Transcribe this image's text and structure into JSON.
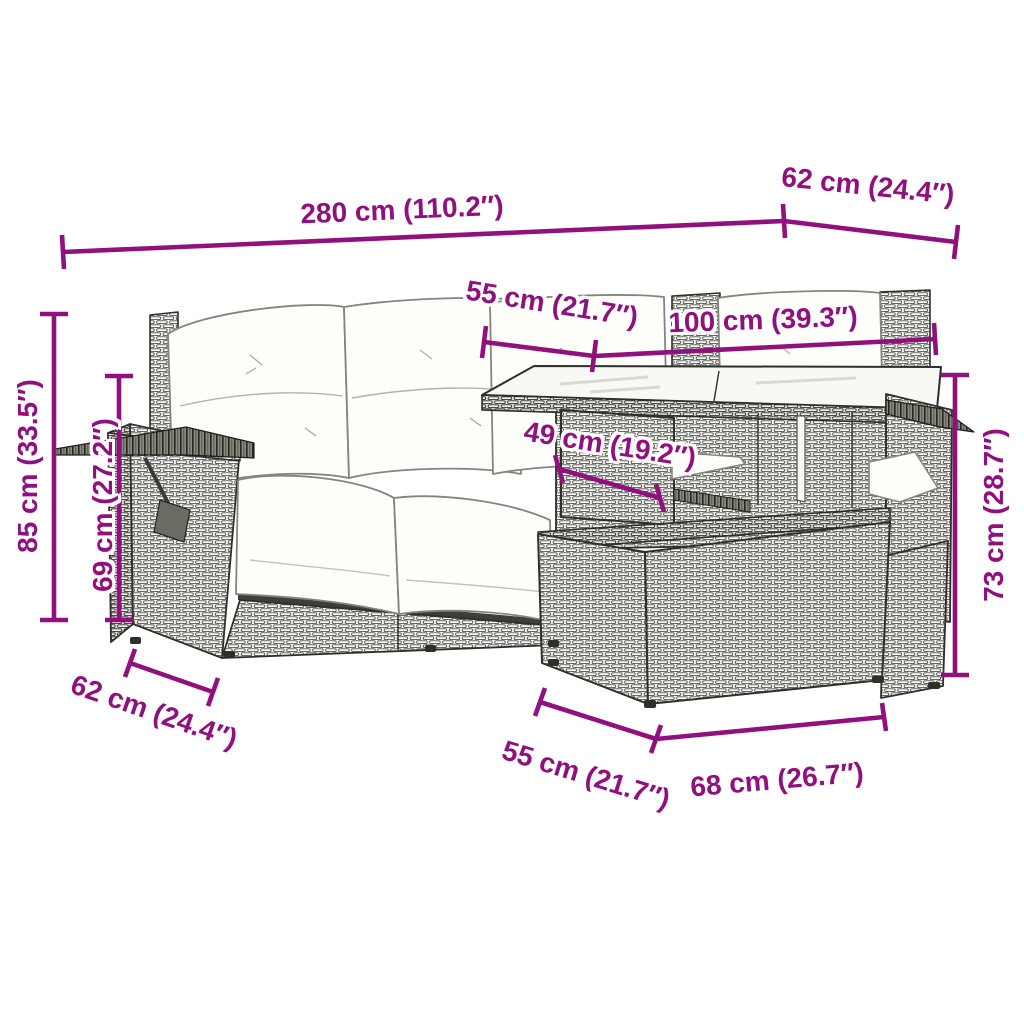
{
  "accent_color": "#90107E",
  "background_color": "#FFFFFF",
  "drawing": {
    "description": "Line drawing of a 5-piece poly rattan garden lounge set with cushions, glass-top table and ottoman"
  },
  "dimensions": {
    "top_width": {
      "text": "280 cm (110.2″)"
    },
    "top_right_depth": {
      "text": "62 cm (24.4″)"
    },
    "upper_55": {
      "text": "55 cm (21.7″)"
    },
    "upper_100": {
      "text": "100 cm (39.3″)"
    },
    "mid_49": {
      "text": "49 cm (19.2″)"
    },
    "left_85": {
      "text": "85 cm (33.5″)"
    },
    "left_69": {
      "text": "69 cm (27.2″)"
    },
    "right_73": {
      "text": "73 cm (28.7″)"
    },
    "bottom_left_62": {
      "text": "62 cm (24.4″)"
    },
    "bottom_55": {
      "text": "55 cm (21.7″)"
    },
    "bottom_68": {
      "text": "68 cm (26.7″)"
    }
  }
}
